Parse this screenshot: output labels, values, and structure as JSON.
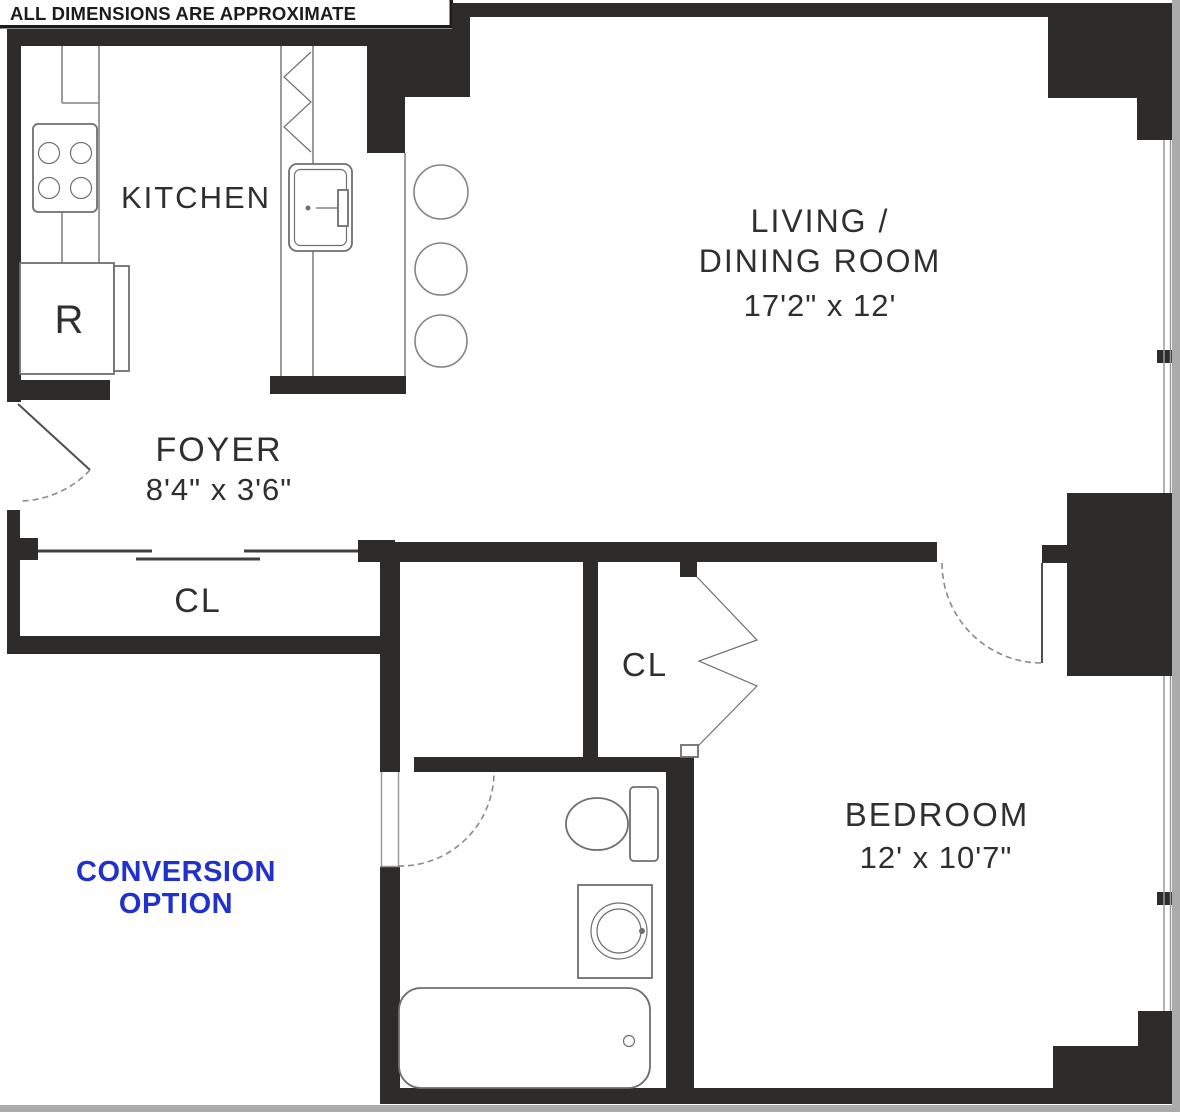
{
  "disclaimer": "ALL DIMENSIONS ARE APPROXIMATE",
  "rooms": {
    "kitchen": {
      "label": "KITCHEN"
    },
    "living": {
      "label_line1": "LIVING /",
      "label_line2": "DINING ROOM",
      "dimensions": "17'2\" x 12'"
    },
    "foyer": {
      "label": "FOYER",
      "dimensions": "8'4\" x 3'6\""
    },
    "closet1": {
      "label": "CL"
    },
    "closet2": {
      "label": "CL"
    },
    "bedroom": {
      "label": "BEDROOM",
      "dimensions": "12' x 10'7\""
    },
    "conversion": {
      "label_line1": "CONVERSION",
      "label_line2": "OPTION"
    }
  },
  "fixtures": {
    "refrigerator": {
      "label": "R"
    }
  },
  "colors": {
    "wall": "#2d2c2a",
    "accent_blue": "#2131cd",
    "line_gray": "#848484",
    "edge_shadow": "#ababab",
    "background": "#ffffff"
  }
}
